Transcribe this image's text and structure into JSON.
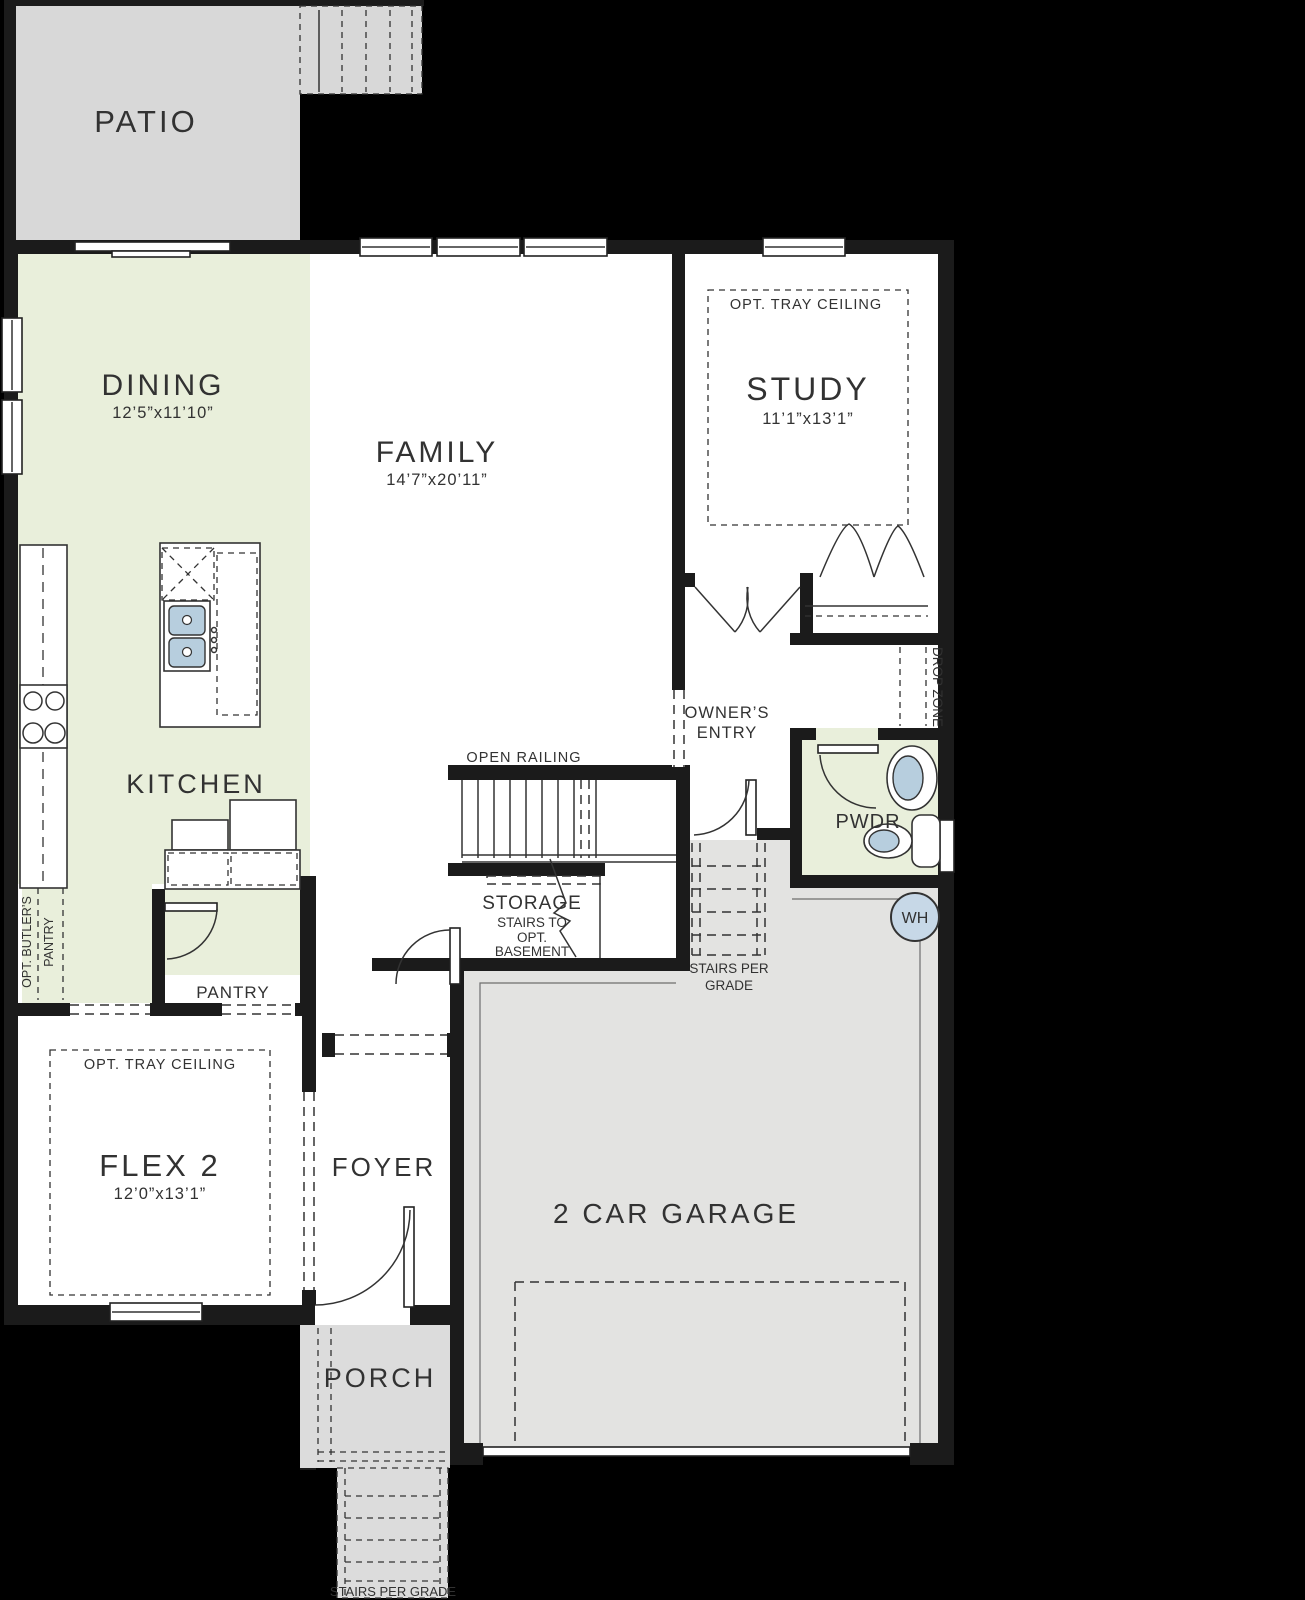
{
  "title": "First floor plan",
  "colors": {
    "background": "#000000",
    "patio_gray": "#d8d8d8",
    "porch_gray": "#dcdcdc",
    "garage_gray": "#e3e3e1",
    "room_green": "#e9efdb",
    "room_white": "#ffffff",
    "wall_black": "#1b1b1b",
    "fixture_blue": "#b7cede",
    "wh_blue": "#c7d8e7",
    "text_gray": "#323232"
  },
  "rooms": {
    "patio": {
      "label": "PATIO"
    },
    "dining": {
      "label": "DINING",
      "dims": "12’5”x11’10”"
    },
    "family": {
      "label": "FAMILY",
      "dims": "14’7”x20’11”"
    },
    "study": {
      "label": "STUDY",
      "dims": "11’1”x13’1”",
      "tray_note": "OPT. TRAY CEILING"
    },
    "kitchen": {
      "label": "KITCHEN"
    },
    "owners_entry": {
      "line1": "OWNER’S",
      "line2": "ENTRY"
    },
    "drop_zone": {
      "label": "DROP ZONE"
    },
    "pwdr": {
      "label": "PWDR"
    },
    "water_heater": {
      "label": "WH"
    },
    "stairs": {
      "open_railing": "OPEN RAILING",
      "storage": "STORAGE",
      "note1": "STAIRS TO",
      "note2": "OPT.",
      "note3": "BASEMENT"
    },
    "garage_stairs": {
      "line1": "STAIRS PER",
      "line2": "GRADE"
    },
    "pantry": {
      "label": "PANTRY"
    },
    "butlers_pantry": {
      "line1": "OPT. BUTLER’S",
      "line2": "PANTRY"
    },
    "flex2": {
      "label": "FLEX 2",
      "dims": "12’0”x13’1”",
      "tray_note": "OPT. TRAY CEILING"
    },
    "foyer": {
      "label": "FOYER"
    },
    "porch": {
      "label": "PORCH",
      "stairs_note": "STAIRS PER GRADE"
    },
    "garage": {
      "label": "2 CAR GARAGE"
    }
  }
}
